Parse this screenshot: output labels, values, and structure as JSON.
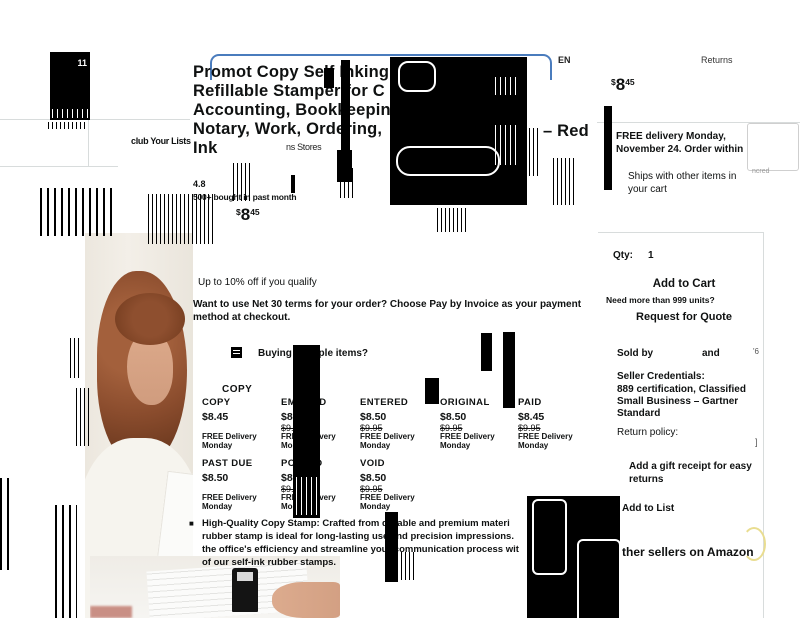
{
  "page": {
    "bg": "#ffffff",
    "accent_blue": "#4a7cbd",
    "arc_yellow": "#e9dd90"
  },
  "nav": {
    "cart_count": "11",
    "lists_glitch": "club Your Lists",
    "language": "EN",
    "returns_label": "Returns"
  },
  "product": {
    "title_line1": "Promot Copy Self Inking",
    "title_line2": "Refillable Stamper for C",
    "title_line3": "Accounting, Bookkeeping,",
    "title_line4": "Notary, Work, Ordering,",
    "title_line5": "Ink",
    "title_suffix": "– Red",
    "store_fragment": "ns Stores",
    "rating": "4.8",
    "bought_note": "500+ bought in past month",
    "price_symbol": "$",
    "price_whole": "8",
    "price_fraction": "45"
  },
  "promo": {
    "coupon": "Up to 10% off  if you qualify",
    "net30": "Want to use Net 30 terms for your order? Choose Pay by Invoice as your payment method at checkout.",
    "bulk_question": "Buying multiple items?"
  },
  "variants": {
    "selected_label": "COPY",
    "row1": [
      {
        "name": "COPY",
        "price": "$8.45",
        "strike": "",
        "del1": "FREE Delivery",
        "del2": "Monday"
      },
      {
        "name": "EMAILED",
        "price": "$8.50",
        "strike": "$9.95",
        "del1": "FREE Delivery",
        "del2": "Monday"
      },
      {
        "name": "ENTERED",
        "price": "$8.50",
        "strike": "$9.95",
        "del1": "FREE Delivery",
        "del2": "Monday"
      },
      {
        "name": "ORIGINAL",
        "price": "$8.50",
        "strike": "$9.95",
        "del1": "FREE Delivery",
        "del2": "Monday"
      },
      {
        "name": "PAID",
        "price": "$8.45",
        "strike": "$9.95",
        "del1": "FREE Delivery",
        "del2": "Monday"
      }
    ],
    "row2": [
      {
        "name": "PAST DUE",
        "price": "$8.50",
        "strike": "",
        "del1": "FREE Delivery",
        "del2": "Monday"
      },
      {
        "name": "POSTED",
        "price": "$8.50",
        "strike": "$9.95",
        "del1": "FREE Delivery",
        "del2": "Monday"
      },
      {
        "name": "VOID",
        "price": "$8.50",
        "strike": "$9.95",
        "del1": "FREE Delivery",
        "del2": "Monday"
      }
    ]
  },
  "bullet": {
    "line1": "High-Quality Copy Stamp: Crafted from durable and premium materi",
    "line2": "rubber stamp is ideal for long-lasting use and precision impressions.",
    "line3": "the office's efficiency and streamline your communication process wit",
    "line4": "of our self-ink rubber stamps."
  },
  "buybox": {
    "price_symbol": "$",
    "price_whole": "8",
    "price_fraction": "45",
    "delivery_line1": "FREE delivery Monday,",
    "delivery_line2": "November 24. Order within",
    "ships_line1": "Ships with other items in",
    "ships_line2": "your cart",
    "qty_label": "Qty:",
    "qty_value": "1",
    "add_to_cart": "Add to Cart",
    "need_more": "Need more than 999 units?",
    "request_quote": "Request for Quote",
    "sold_by_label": "Sold by",
    "sold_by_and": "and",
    "fragment_6": "'6",
    "credentials_title": "Seller Credentials:",
    "credentials_line1": "889 certification,  Classified",
    "credentials_line2": "Small Business – Gartner",
    "credentials_line3": "Standard",
    "return_policy": "Return policy:",
    "fragment_bracket": "]",
    "gift_line1": "Add a gift receipt for easy",
    "gift_line2": "returns",
    "add_to_list": "Add to List",
    "other_sellers": "ther sellers on Amazon",
    "fragment_ncred": "ncred"
  }
}
